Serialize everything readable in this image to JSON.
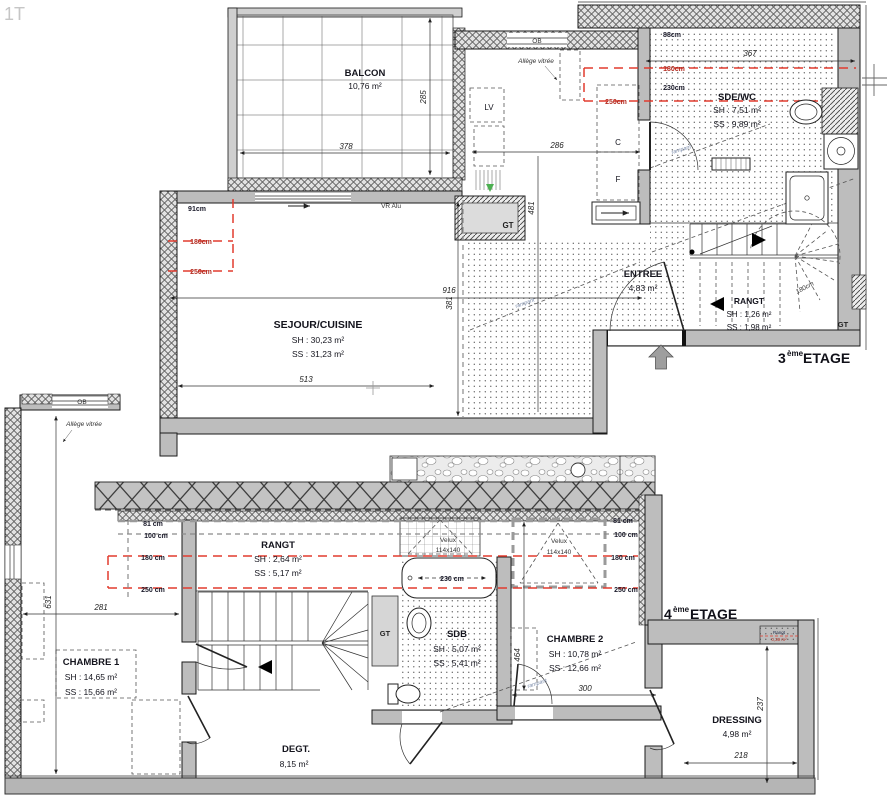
{
  "plan_code": "1T",
  "colors": {
    "wall": "#bdbdbd",
    "red_line": "#e23b2e",
    "text": "#14141d"
  },
  "floor3": {
    "title": {
      "num": "3",
      "sup": "ème",
      "word": "ETAGE"
    },
    "balcon": {
      "name": "BALCON",
      "area": "10,76 m²",
      "width": "378",
      "height": "285"
    },
    "sejour": {
      "name": "SEJOUR/CUISINE",
      "sh": "SH : 30,23 m²",
      "ss": "SS : 31,23 m²",
      "width": "513",
      "height": "381",
      "total_width": "916"
    },
    "kitchen": {
      "window": "OB",
      "allege": "Allège vitrée",
      "vr": "VR Alu",
      "lv": "LV",
      "c": "C",
      "f": "F",
      "width": "286",
      "height": "481",
      "d91": "91cm",
      "h180": "180cm",
      "h250": "250cm",
      "gt": "GT"
    },
    "sde": {
      "name": "SDE/WC",
      "sh": "SH : 7,51 m²",
      "ss": "SS : 9,89 m²",
      "width": "367",
      "d88": "88cm",
      "h180": "180cm",
      "h230": "230cm",
      "h250": "250cm"
    },
    "entree": {
      "name": "ENTREE",
      "area": "4,83 m²"
    },
    "rangt": {
      "name": "RANGT",
      "sh": "SH : 1,26 m²",
      "ss": "SS : 1,98 m²",
      "h180": "180cm"
    },
    "gt_corner": "GT",
    "rampant1": "rampant",
    "rampant2": "rampant"
  },
  "floor4": {
    "title": {
      "num": "4",
      "sup": "ème",
      "word": "ETAGE"
    },
    "window": "OB",
    "allege": "Allège vitrée",
    "chambre1": {
      "name": "CHAMBRE 1",
      "sh": "SH : 14,65 m²",
      "ss": "SS : 15,66 m²",
      "width": "281",
      "height": "631"
    },
    "rangt": {
      "name": "RANGT",
      "sh": "SH : 2,64 m²",
      "ss": "SS : 5,17 m²"
    },
    "heights_left": {
      "h81": "81 cm",
      "h100": "100 cm",
      "h180": "180 cm",
      "h250": "250 cm"
    },
    "heights_right": {
      "h81": "81 cm",
      "h100": "100 cm",
      "h180": "180 cm",
      "h250": "250 cm"
    },
    "velux1": {
      "l1": "Velux",
      "l2": "114x140"
    },
    "velux2": {
      "l1": "Velux",
      "l2": "114x140"
    },
    "sdb": {
      "name": "SDB",
      "sh": "SH : 5,07 m²",
      "ss": "SS : 5,41 m²",
      "tub": "230 cm",
      "gt": "GT"
    },
    "chambre2": {
      "name": "CHAMBRE 2",
      "sh": "SH : 10,78 m²",
      "ss": "SS : 12,66 m²",
      "width": "300",
      "height": "464"
    },
    "degt": {
      "name": "DEGT.",
      "area": "8,15 m²"
    },
    "dressing": {
      "name": "DRESSING",
      "area": "4,98 m²",
      "width": "218",
      "height": "237"
    },
    "niche": {
      "l1": "Rangt",
      "l2": "0,39 m²"
    },
    "rampant": "rampant"
  }
}
